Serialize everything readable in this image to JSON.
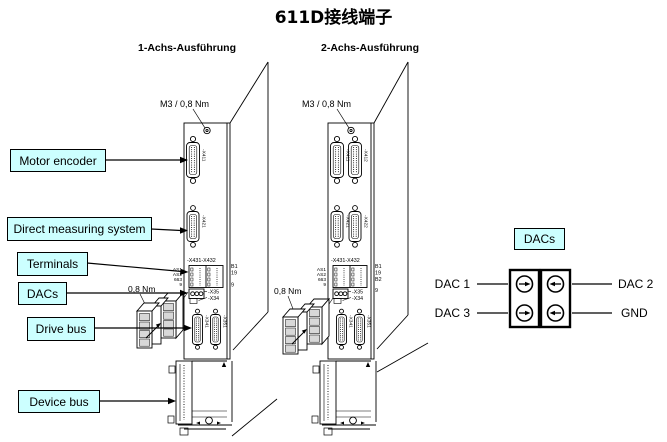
{
  "title": "611D接线端子",
  "colors": {
    "label_bg": "#CCFFFF",
    "line": "#000000"
  },
  "callouts": {
    "motor_encoder": "Motor encoder",
    "direct_measuring_system": "Direct measuring system",
    "terminals": "Terminals",
    "dacs": "DACs",
    "drive_bus": "Drive bus",
    "device_bus": "Device bus"
  },
  "modules": {
    "m1": {
      "header": "1-Achs-Ausführung",
      "screw_torque": "M3 / 0,8 Nm",
      "plug_torque": "0,8 Nm",
      "terminal_block": "-X431-X432",
      "x35_label": "-X35",
      "x34_label": "-X34",
      "left_pins": [
        "AS1",
        "AS2",
        "663",
        "9"
      ],
      "right_pins": [
        "B1",
        "19",
        "9"
      ],
      "connector_labels": {
        "encoder1": "-X411",
        "dms1": "-X421",
        "bus1": "-X341",
        "bus2": "-X351"
      }
    },
    "m2": {
      "header": "2-Achs-Ausführung",
      "screw_torque": "M3 / 0,8 Nm",
      "plug_torque": "0,8 Nm",
      "terminal_block": "-X431-X432",
      "x35_label": "-X35",
      "x34_label": "-X34",
      "left_pins": [
        "AS1",
        "AS2",
        "663",
        "9"
      ],
      "right_pins": [
        "B1",
        "19",
        "B2",
        "9"
      ],
      "connector_labels": {
        "encoder1": "-X411",
        "encoder2": "-X412",
        "dms1": "-X421",
        "dms2": "-X422",
        "bus1": "-X341",
        "bus2": "-X351"
      }
    }
  },
  "dac_detail": {
    "title": "DACs",
    "left_labels": [
      "DAC 1",
      "DAC 3"
    ],
    "right_labels": [
      "DAC 2",
      "GND"
    ]
  }
}
